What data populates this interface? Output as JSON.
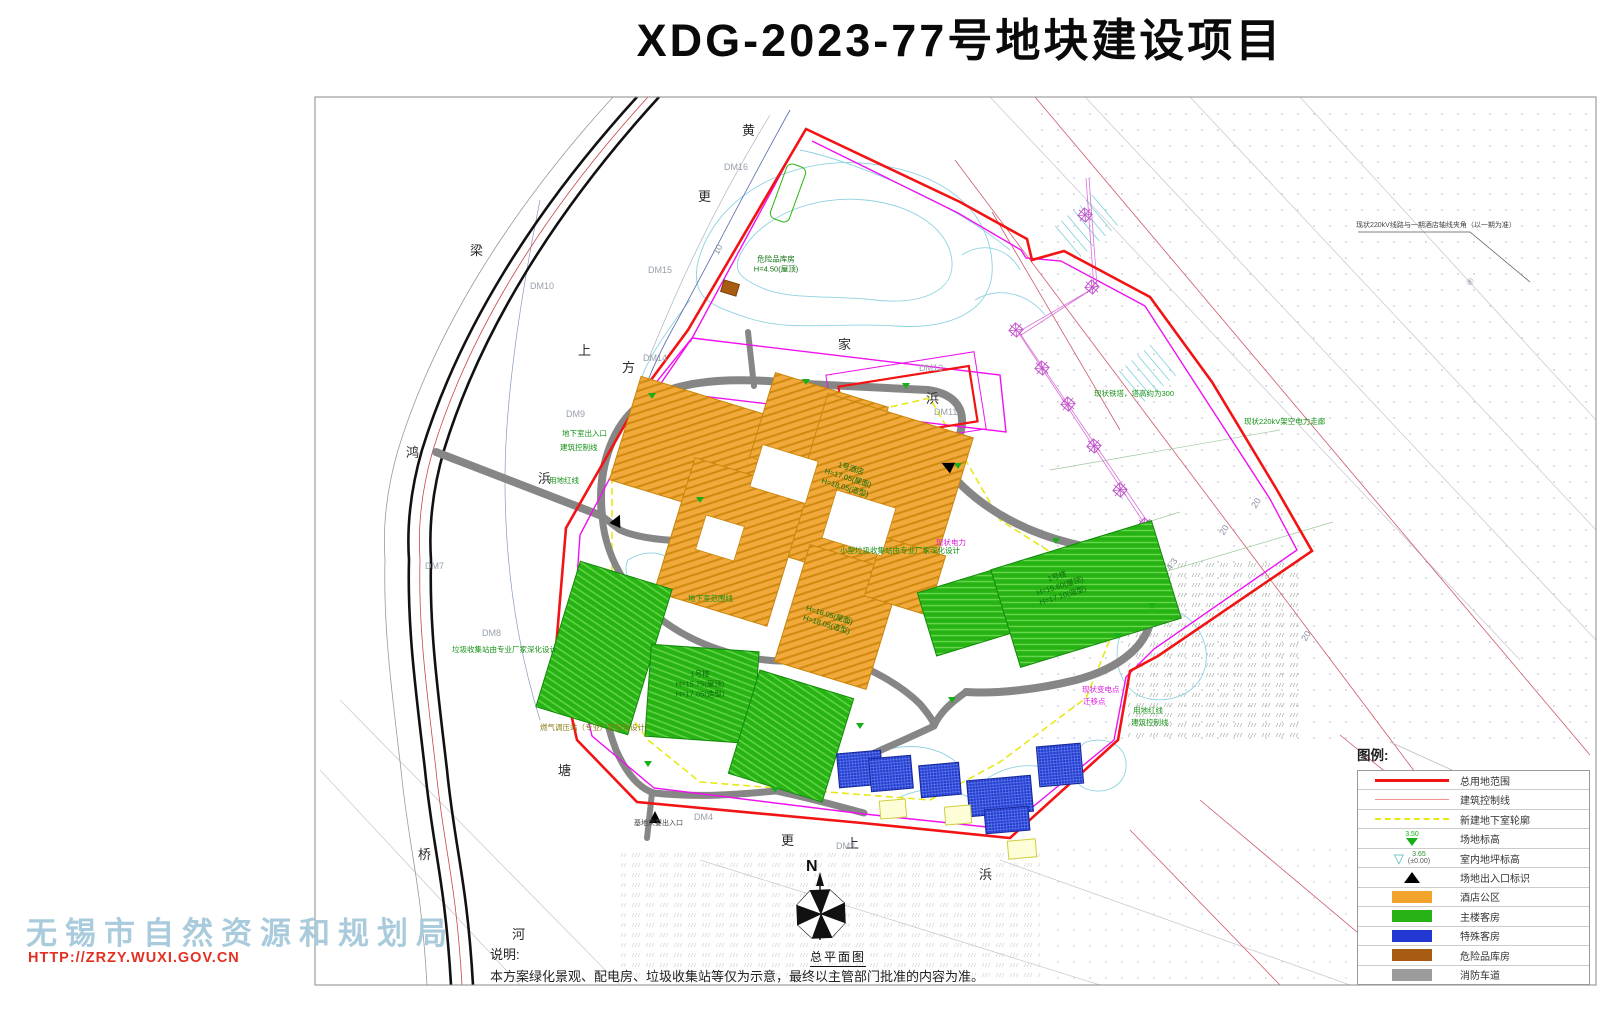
{
  "title": "XDG-2023-77号地块建设项目",
  "plan_label": "总平面图",
  "compass": {
    "north": "N"
  },
  "note": {
    "heading": "说明:",
    "body": "本方案绿化景观、配电房、垃圾收集站等仅为示意，最终以主管部门批准的内容为准。"
  },
  "watermark": {
    "org": "无锡市自然资源和规划局",
    "url": "HTTP://ZRZY.WUXI.GOV.CN"
  },
  "legend": {
    "title": "图例:",
    "items": [
      {
        "kind": "line-thick",
        "color": "#f21414",
        "label": "总用地范围"
      },
      {
        "kind": "line-thin",
        "color": "#f49090",
        "label": "建筑控制线"
      },
      {
        "kind": "line-dash",
        "color": "#e8e818",
        "label": "新建地下室轮廓"
      },
      {
        "kind": "tri-green",
        "color": "#18b018",
        "value": "3.50",
        "label": "场地标高"
      },
      {
        "kind": "tri-open",
        "color": "#48b8b8",
        "value": "3.65",
        "value2": "(±0.00)",
        "label": "室内地坪标高"
      },
      {
        "kind": "tri-black",
        "color": "#000000",
        "label": "场地出入口标识"
      },
      {
        "kind": "swatch",
        "color": "#f2a32b",
        "label": "酒店公区"
      },
      {
        "kind": "swatch",
        "color": "#27b216",
        "label": "主楼客房"
      },
      {
        "kind": "swatch",
        "color": "#2238d0",
        "label": "特殊客房"
      },
      {
        "kind": "swatch",
        "color": "#a85c12",
        "label": "危险品库房"
      },
      {
        "kind": "swatch",
        "color": "#9c9c9c",
        "label": "消防车道"
      }
    ]
  },
  "map_labels": [
    {
      "t": "黄",
      "x": 742,
      "y": 124,
      "cls": "street"
    },
    {
      "t": "更",
      "x": 698,
      "y": 190,
      "cls": "street"
    },
    {
      "t": "梁",
      "x": 470,
      "y": 244,
      "cls": "street"
    },
    {
      "t": "鸿",
      "x": 406,
      "y": 446,
      "cls": "street"
    },
    {
      "t": "浜",
      "x": 538,
      "y": 472,
      "cls": "street"
    },
    {
      "t": "上",
      "x": 578,
      "y": 344,
      "cls": "street"
    },
    {
      "t": "方",
      "x": 622,
      "y": 361,
      "cls": "street"
    },
    {
      "t": "家",
      "x": 838,
      "y": 338,
      "cls": "street"
    },
    {
      "t": "浜",
      "x": 926,
      "y": 392,
      "cls": "street"
    },
    {
      "t": "塘",
      "x": 558,
      "y": 764,
      "cls": "street"
    },
    {
      "t": "桥",
      "x": 418,
      "y": 848,
      "cls": "street"
    },
    {
      "t": "河",
      "x": 512,
      "y": 928,
      "cls": "street"
    },
    {
      "t": "更",
      "x": 781,
      "y": 834,
      "cls": "street"
    },
    {
      "t": "上",
      "x": 846,
      "y": 837,
      "cls": "street"
    },
    {
      "t": "浜",
      "x": 979,
      "y": 868,
      "cls": "street"
    },
    {
      "t": "DM16",
      "x": 724,
      "y": 163,
      "cls": "dm"
    },
    {
      "t": "DM15",
      "x": 648,
      "y": 266,
      "cls": "dm"
    },
    {
      "t": "DM10",
      "x": 530,
      "y": 282,
      "cls": "dm"
    },
    {
      "t": "DM9",
      "x": 566,
      "y": 410,
      "cls": "dm"
    },
    {
      "t": "DM14",
      "x": 643,
      "y": 354,
      "cls": "dm"
    },
    {
      "t": "DM8",
      "x": 482,
      "y": 629,
      "cls": "dm"
    },
    {
      "t": "DM7",
      "x": 425,
      "y": 562,
      "cls": "dm"
    },
    {
      "t": "DM13",
      "x": 919,
      "y": 364,
      "cls": "dm"
    },
    {
      "t": "DM11",
      "x": 934,
      "y": 408,
      "cls": "dm"
    },
    {
      "t": "DM4",
      "x": 694,
      "y": 813,
      "cls": "dm"
    },
    {
      "t": "DM3",
      "x": 836,
      "y": 842,
      "cls": "dm"
    },
    {
      "t": "⑥",
      "x": 1466,
      "y": 278,
      "cls": "dm"
    },
    {
      "t": "20",
      "x": 1250,
      "y": 505,
      "cls": "num",
      "rot": -58
    },
    {
      "t": "20",
      "x": 1218,
      "y": 532,
      "cls": "num",
      "rot": -58
    },
    {
      "t": "20",
      "x": 1300,
      "y": 638,
      "cls": "num",
      "rot": -58
    },
    {
      "t": "4.3",
      "x": 1165,
      "y": 567,
      "cls": "num",
      "rot": -55
    },
    {
      "t": "10",
      "x": 712,
      "y": 252,
      "cls": "num",
      "rot": -62
    },
    {
      "t": "地下室出入口",
      "x": 562,
      "y": 430,
      "cls": "ann-g"
    },
    {
      "t": "建筑控制线",
      "x": 560,
      "y": 444,
      "cls": "ann-g"
    },
    {
      "t": "用地红线",
      "x": 549,
      "y": 477,
      "cls": "ann-g"
    },
    {
      "t": "用地红线",
      "x": 1133,
      "y": 707,
      "cls": "ann-g"
    },
    {
      "t": "建筑控制线",
      "x": 1131,
      "y": 719,
      "cls": "ann-g"
    },
    {
      "t": "现状铁塔，塔高约为300",
      "x": 1094,
      "y": 390,
      "cls": "ann-g"
    },
    {
      "t": "现状220kV架空电力走廊",
      "x": 1244,
      "y": 418,
      "cls": "ann-g"
    },
    {
      "t": "小型垃圾收集站由专业厂家深化设计",
      "x": 840,
      "y": 547,
      "cls": "ann-g"
    },
    {
      "t": "垃圾收集站由专业厂家深化设计",
      "x": 452,
      "y": 646,
      "cls": "ann-g"
    },
    {
      "t": "地下室范围线",
      "x": 688,
      "y": 595,
      "cls": "ann-g"
    },
    {
      "t": "现状变电点",
      "x": 1082,
      "y": 686,
      "cls": "ann-m"
    },
    {
      "t": "迁移点",
      "x": 1083,
      "y": 698,
      "cls": "ann-m"
    },
    {
      "t": "现状电力",
      "x": 936,
      "y": 539,
      "cls": "ann-m"
    },
    {
      "t": "基地次要出入口",
      "x": 634,
      "y": 820,
      "cls": "ann-k"
    },
    {
      "t": "现状220kV线路与一期酒店轴线夹角（以一期为准）",
      "x": 1356,
      "y": 222,
      "cls": "ann-k"
    },
    {
      "t": "燃气调压站（专业厂家深化设计）",
      "x": 540,
      "y": 724,
      "cls": "ann-o"
    }
  ],
  "building_labels": [
    {
      "x": 848,
      "y": 478,
      "rot": 17,
      "lines": [
        "1号酒店",
        "H=17.05(屋面)",
        "H=18.05(造型)"
      ]
    },
    {
      "x": 828,
      "y": 620,
      "rot": 17,
      "lines": [
        "H=16.05(屋面)",
        "H=18.05(造型)"
      ]
    },
    {
      "x": 700,
      "y": 684,
      "rot": 0,
      "lines": [
        "1号楼",
        "H=15.75(屋顶)",
        "H=17.05(造型)"
      ]
    },
    {
      "x": 1060,
      "y": 586,
      "rot": -17,
      "lines": [
        "1号楼",
        "H=15.60(屋顶)",
        "H=17.10(造型)"
      ]
    },
    {
      "x": 776,
      "y": 264,
      "rot": 0,
      "lines": [
        "危险品库房",
        "H=4.50(屋顶)"
      ]
    }
  ],
  "buildings": [
    {
      "t": "hotel",
      "x": 622,
      "y": 396,
      "w": 150,
      "h": 108,
      "r": 17
    },
    {
      "t": "hotel",
      "x": 760,
      "y": 388,
      "w": 118,
      "h": 88,
      "r": 17
    },
    {
      "t": "hotel",
      "x": 800,
      "y": 412,
      "w": 152,
      "h": 168,
      "r": 17
    },
    {
      "t": "hotel",
      "x": 672,
      "y": 472,
      "w": 118,
      "h": 140,
      "r": 17
    },
    {
      "t": "hotel",
      "x": 790,
      "y": 556,
      "w": 96,
      "h": 122,
      "r": 17
    },
    {
      "t": "hotel",
      "x": 872,
      "y": 545,
      "w": 66,
      "h": 62,
      "r": 17
    },
    {
      "t": "hole",
      "x": 755,
      "y": 452,
      "w": 58,
      "h": 44,
      "r": 17
    },
    {
      "t": "hole",
      "x": 828,
      "y": 498,
      "w": 62,
      "h": 50,
      "r": 17
    },
    {
      "t": "hole",
      "x": 700,
      "y": 520,
      "w": 40,
      "h": 36,
      "r": 17
    },
    {
      "t": "guest",
      "x": 556,
      "y": 572,
      "w": 96,
      "h": 152,
      "r": 17
    },
    {
      "t": "guest",
      "x": 648,
      "y": 648,
      "w": 108,
      "h": 92,
      "r": 4
    },
    {
      "t": "guest",
      "x": 742,
      "y": 682,
      "w": 98,
      "h": 108,
      "r": 17
    },
    {
      "t": "guest",
      "x": 925,
      "y": 578,
      "w": 92,
      "h": 66,
      "r": -17
    },
    {
      "t": "guest",
      "x": 1002,
      "y": 543,
      "w": 168,
      "h": 102,
      "r": -17
    },
    {
      "t": "special",
      "x": 838,
      "y": 752,
      "w": 44,
      "h": 34,
      "r": -5
    },
    {
      "t": "special",
      "x": 870,
      "y": 757,
      "w": 42,
      "h": 33,
      "r": -5
    },
    {
      "t": "special",
      "x": 920,
      "y": 764,
      "w": 40,
      "h": 32,
      "r": -5
    },
    {
      "t": "special",
      "x": 968,
      "y": 778,
      "w": 64,
      "h": 36,
      "r": -5
    },
    {
      "t": "special",
      "x": 985,
      "y": 808,
      "w": 44,
      "h": 24,
      "r": -5
    },
    {
      "t": "special",
      "x": 1038,
      "y": 745,
      "w": 44,
      "h": 40,
      "r": -5
    },
    {
      "t": "pad",
      "x": 880,
      "y": 800,
      "w": 26,
      "h": 18,
      "r": -5
    },
    {
      "t": "pad",
      "x": 945,
      "y": 806,
      "w": 26,
      "h": 18,
      "r": -5
    },
    {
      "t": "pad",
      "x": 1008,
      "y": 840,
      "w": 28,
      "h": 18,
      "r": -5
    },
    {
      "t": "hazard",
      "x": 722,
      "y": 282,
      "w": 16,
      "h": 12,
      "r": 17
    },
    {
      "t": "strip",
      "x": 778,
      "y": 164,
      "w": 20,
      "h": 58,
      "r": 20
    }
  ],
  "pylons": [
    [
      1092,
      287
    ],
    [
      1085,
      215
    ],
    [
      1016,
      330
    ],
    [
      1042,
      368
    ],
    [
      1068,
      404
    ],
    [
      1094,
      446
    ],
    [
      1120,
      490
    ],
    [
      1145,
      525
    ]
  ],
  "elevation_marks": [
    [
      652,
      396
    ],
    [
      806,
      382
    ],
    [
      906,
      386
    ],
    [
      958,
      466
    ],
    [
      1056,
      541
    ],
    [
      1118,
      636
    ],
    [
      952,
      700
    ],
    [
      860,
      726
    ],
    [
      700,
      500
    ],
    [
      648,
      764
    ],
    [
      775,
      790
    ],
    [
      1152,
      606
    ]
  ],
  "entrances": [
    [
      617,
      521,
      25
    ],
    [
      655,
      818,
      0
    ],
    [
      948,
      466,
      -65
    ]
  ],
  "colors": {
    "boundary_red": "#f21414",
    "control_magenta": "#f010f0",
    "basement_yellow": "#e8e818",
    "road_gray": "#868686",
    "hotel_orange": "#f2a93b",
    "guest_green": "#28b315",
    "special_blue": "#2139cc",
    "hazard_brown": "#a85c12",
    "contour_cyan": "#8fd2e0"
  }
}
